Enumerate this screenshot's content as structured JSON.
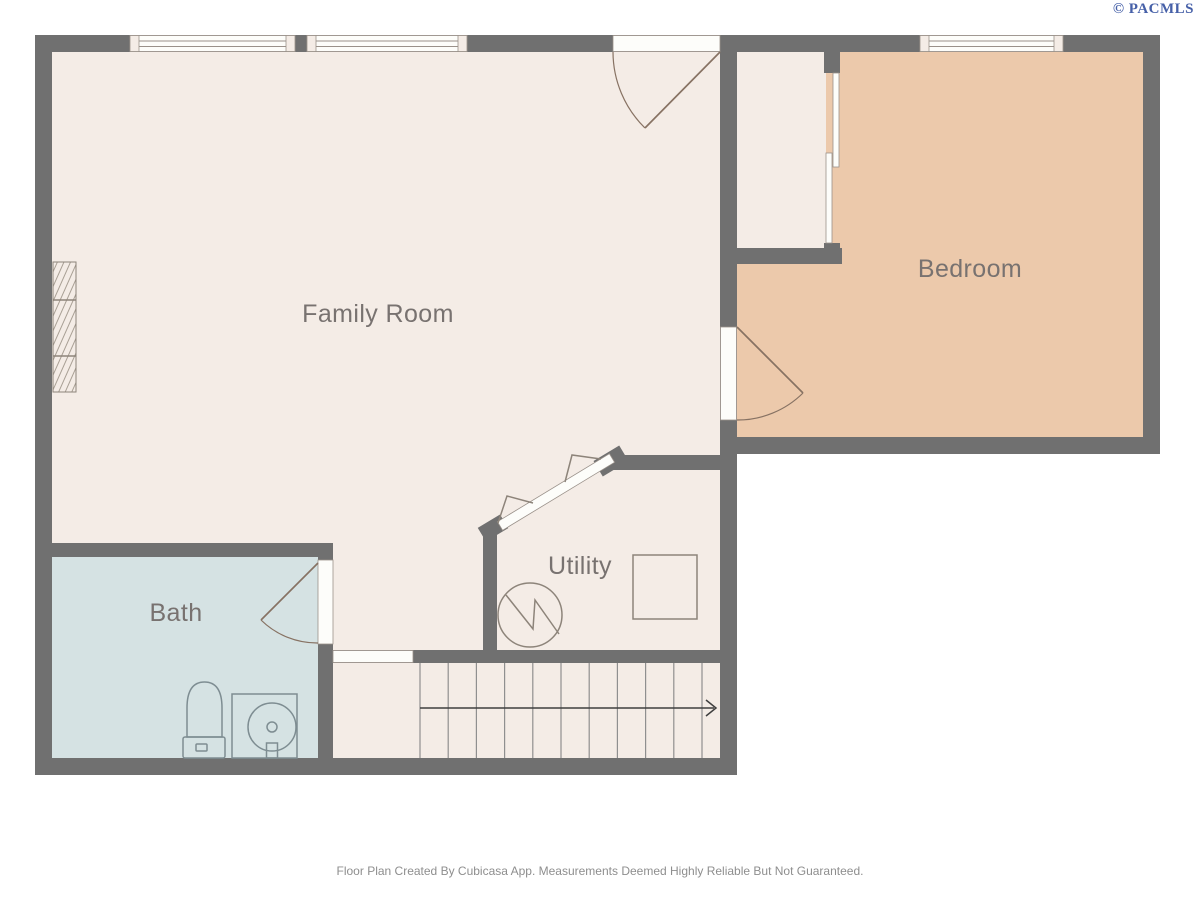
{
  "page": {
    "watermark": "© PACMLS",
    "footer": "Floor Plan Created By Cubicasa App. Measurements Deemed Highly Reliable But Not Guaranteed."
  },
  "floor_plan": {
    "type": "floor-plan",
    "rooms": [
      {
        "name": "Family Room"
      },
      {
        "name": "Bedroom"
      },
      {
        "name": "Bath"
      },
      {
        "name": "Utility"
      }
    ],
    "symbols": {
      "window": "triple-line window band in wall",
      "door_swing": "quarter-circle door swing arc",
      "sliding_door": "bypass sliding closet door",
      "bifold_door": "diagonal bifold door with zigzag folds",
      "stairs": "straight stair run with direction arrow",
      "toilet": "toilet with tank, in bath",
      "shower": "square shower stall with round base and drain",
      "water_heater": "circle with lightning zigzag, in utility",
      "appliance": "square appliance outline, in utility",
      "fireplace": "hatched built-in on family room west wall"
    },
    "colors": {
      "wall": "#707070",
      "room_cream": "#f4ece6",
      "room_tan": "#ecc9ab",
      "room_blue": "#d5e2e3",
      "label_text": "#787270",
      "watermark_blue": "#4660a8",
      "footer_text": "#8e8e8e",
      "door_line": "#877263",
      "fixture_line": "#7e8d92",
      "symbol_line": "#8d847a",
      "stair_line": "#8f8f8f",
      "arrow_line": "#3f3f3f",
      "window_line": "#9a918a",
      "opening_fill": "#fdfdfa"
    }
  }
}
